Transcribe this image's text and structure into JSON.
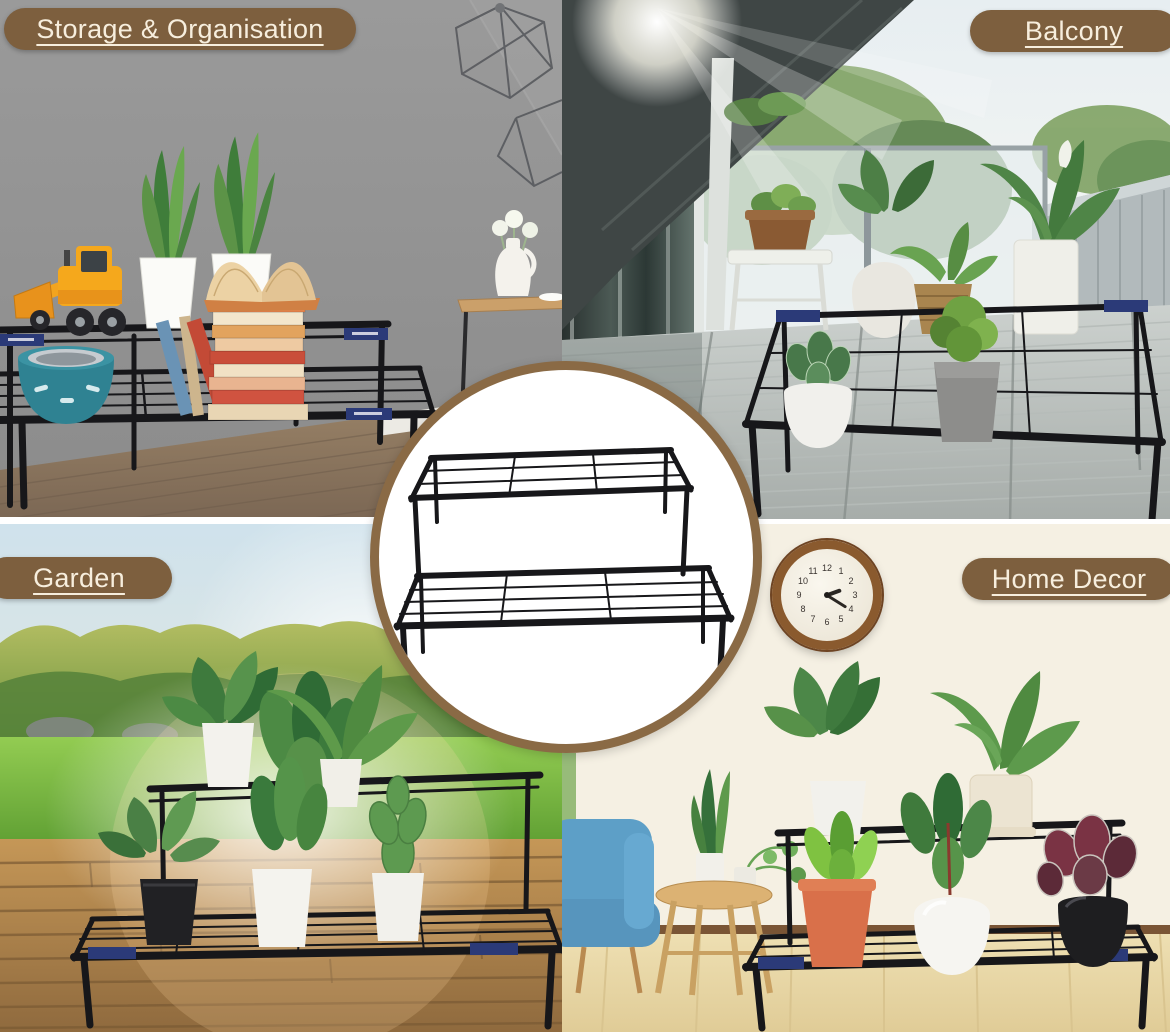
{
  "labels": {
    "storage": "Storage & Organisation",
    "balcony": "Balcony",
    "garden": "Garden",
    "home_decor": "Home Decor"
  },
  "clock": {
    "numerals": [
      "12",
      "1",
      "2",
      "3",
      "4",
      "5",
      "6",
      "7",
      "8",
      "9",
      "10",
      "11"
    ],
    "time_shown": "2:20"
  },
  "colors": {
    "label_background": "#7d5f3e",
    "label_text": "#f7eedd",
    "inset_ring": "#8a6a45",
    "stand_metal": "#17171a",
    "storage_wall": "#929292",
    "bowl_teal": "#2f8292",
    "toy_yellow": "#f5a81c",
    "garden_grass": "#6fae3e",
    "home_wall": "#f5f0e3",
    "terracotta_pot": "#d9704a",
    "armchair_blue": "#5d9fc7"
  }
}
